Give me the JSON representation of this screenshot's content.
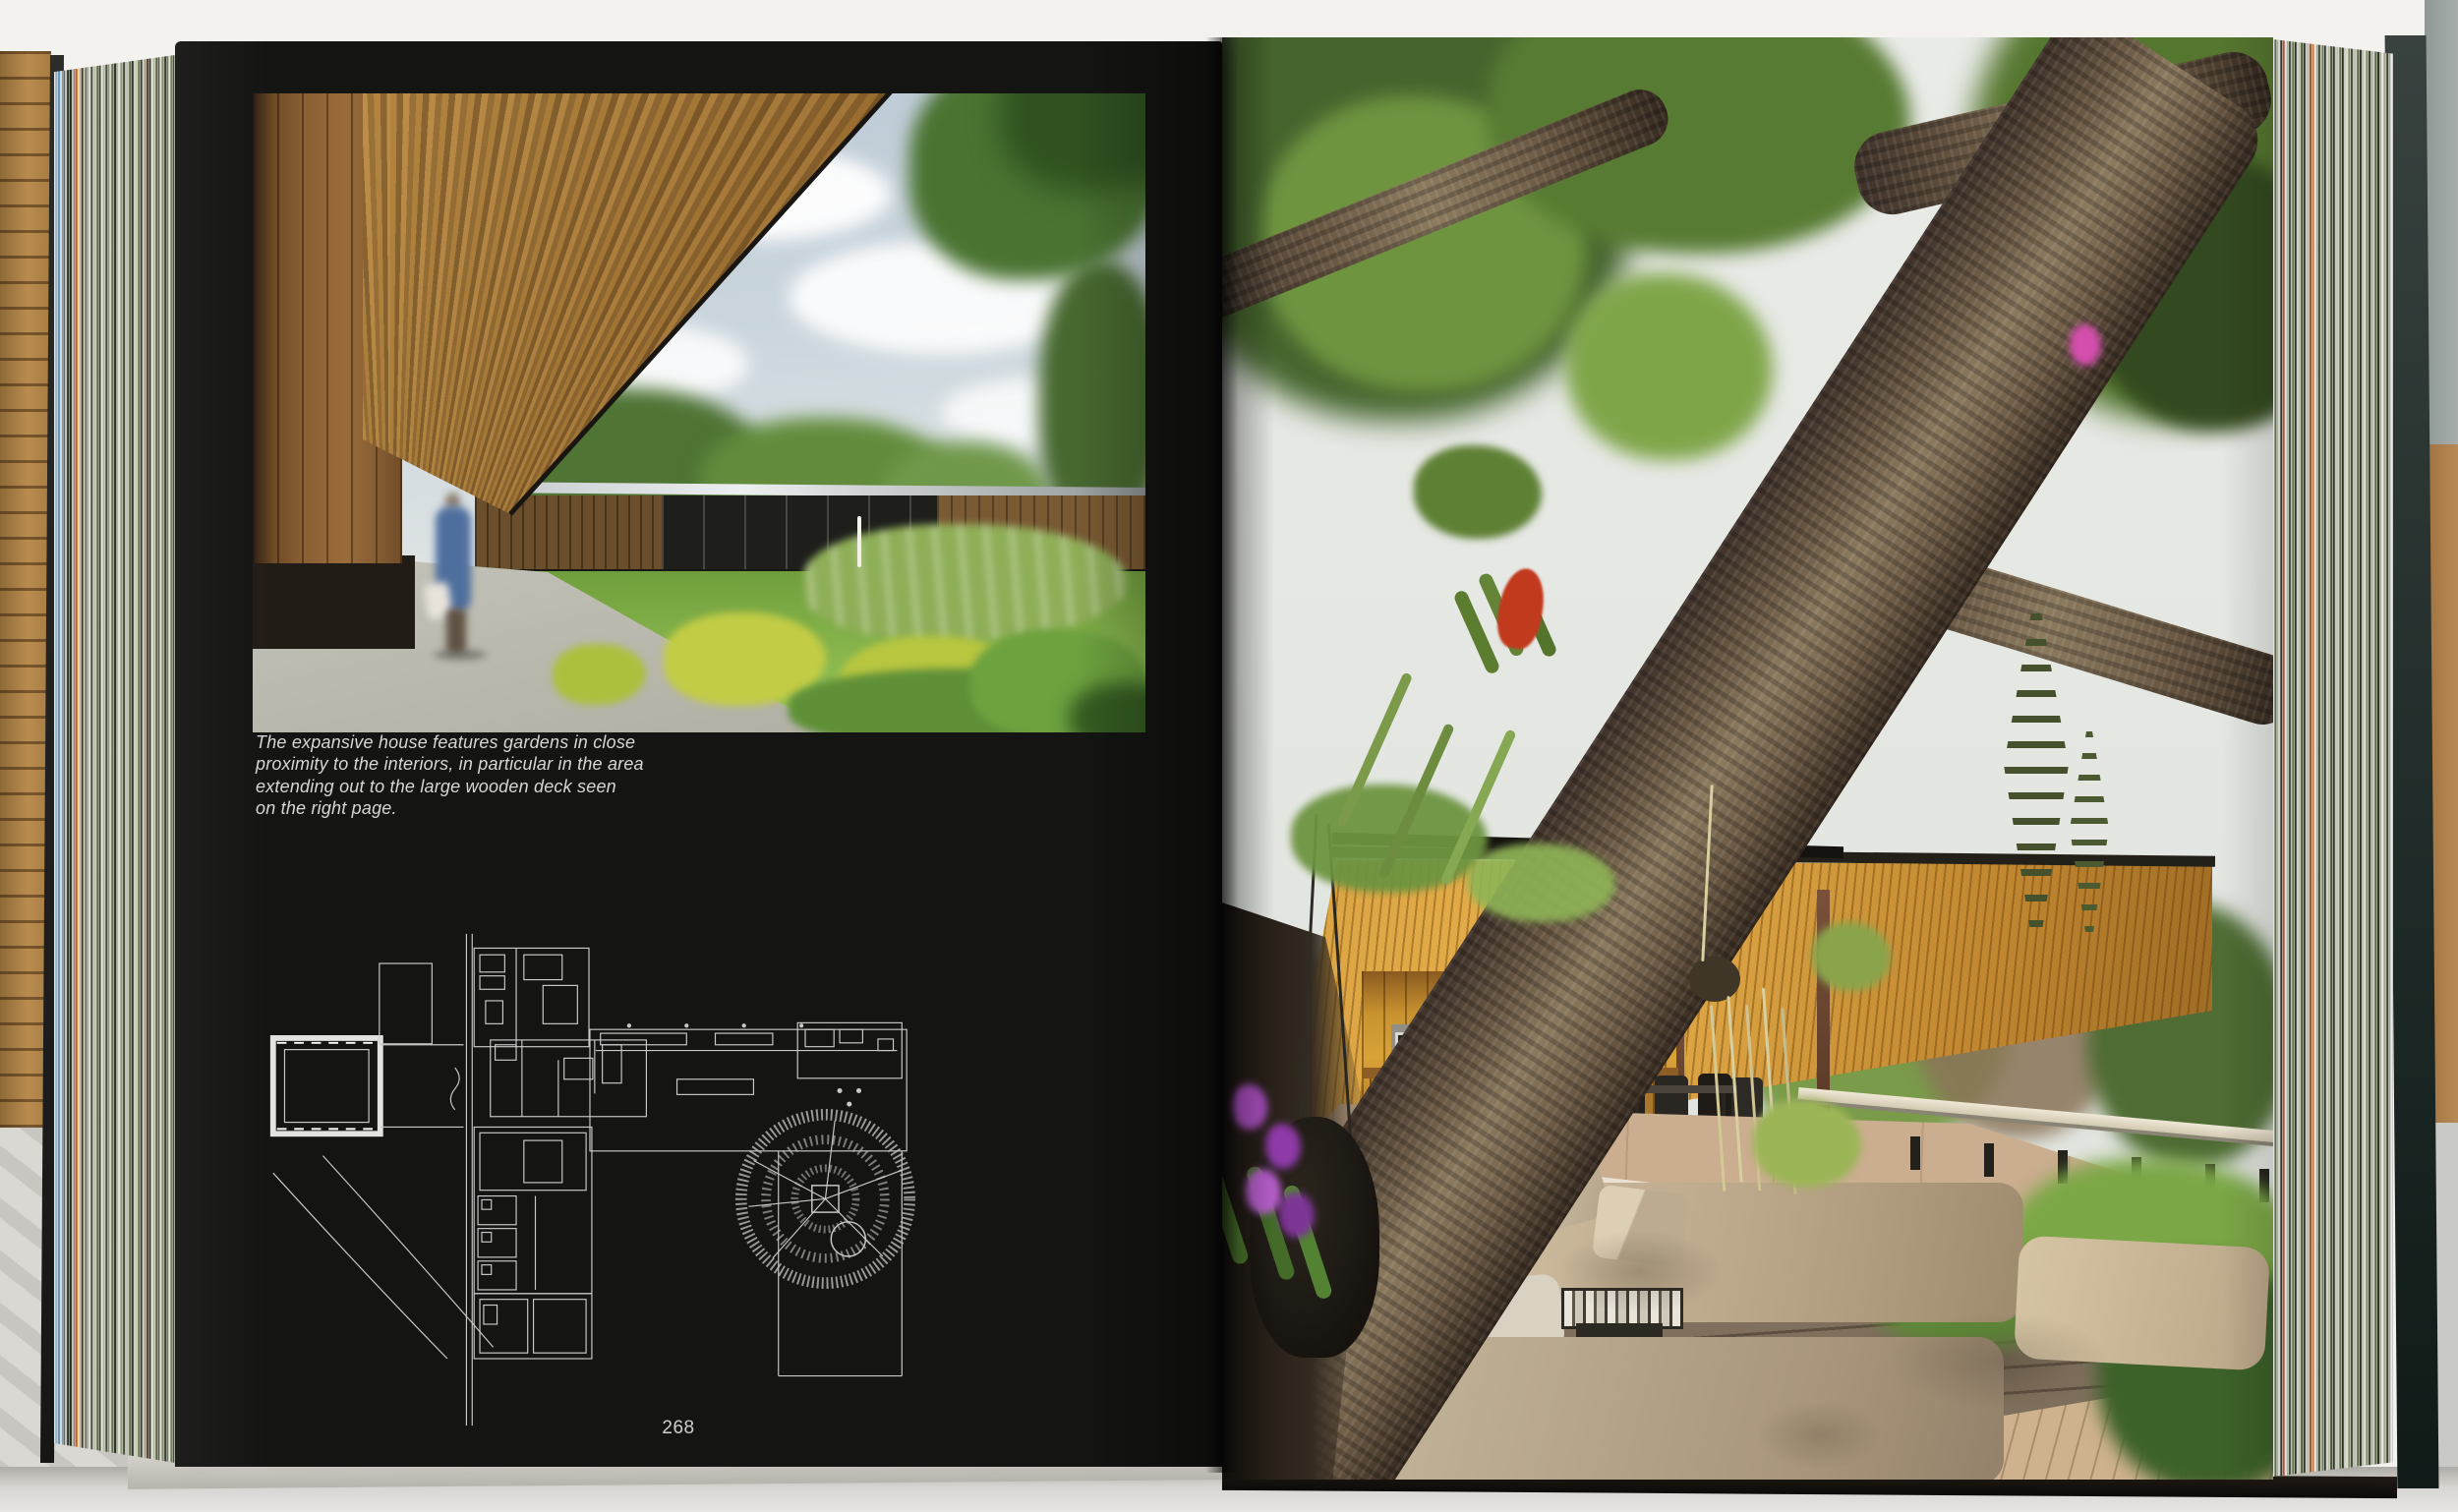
{
  "book": {
    "left_page": {
      "caption": "The expansive house features gardens in close\nproximity to the interiors, in particular in the area\nextending out to the large wooden deck seen\non the right page.",
      "page_number": "268"
    },
    "colors": {
      "page_black": "#141413",
      "caption_text": "#d6d6d4",
      "plan_line": "#c9c9c9",
      "roof_wood": "#d9a338",
      "ceiling_wood": "#a9772f",
      "sky_left_photo": "#c3cfd9",
      "sky_right_photo": "#e8eae6",
      "lawn_green": "#8ab84e",
      "trunk_brown": "#6b5a45",
      "deck_orange": "#b5713c",
      "cushion_taupe": "#c4b59a",
      "orchid_purple": "#a94fc0",
      "bromeliad_red": "#c23a1e"
    }
  }
}
